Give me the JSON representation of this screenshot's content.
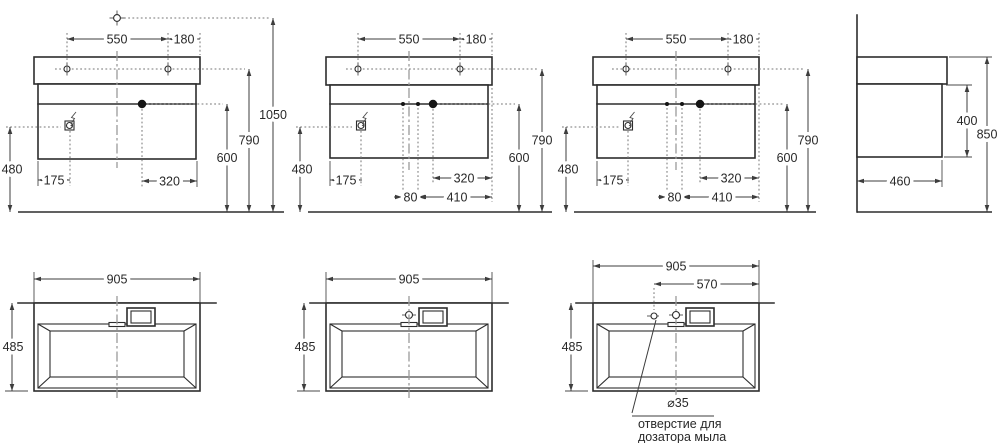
{
  "drawing": {
    "kind": "washbasin-with-cabinet-dimension-drawing",
    "front_views": [
      {
        "name": "front-overall",
        "dim_550": "550",
        "dim_180": "180",
        "dim_1050": "1050",
        "dim_790": "790",
        "dim_600": "600",
        "dim_480": "480",
        "dim_175": "175",
        "dim_320": "320"
      },
      {
        "name": "front-variant-2",
        "dim_550": "550",
        "dim_180": "180",
        "dim_790": "790",
        "dim_600": "600",
        "dim_480": "480",
        "dim_175": "175",
        "dim_320": "320",
        "dim_80": "80",
        "dim_410": "410"
      },
      {
        "name": "front-variant-3",
        "dim_550": "550",
        "dim_180": "180",
        "dim_790": "790",
        "dim_600": "600",
        "dim_480": "480",
        "dim_175": "175",
        "dim_320": "320",
        "dim_80": "80",
        "dim_410": "410"
      }
    ],
    "side_view": {
      "dim_400": "400",
      "dim_850": "850",
      "dim_460": "460"
    },
    "plan_views": [
      {
        "name": "plan-no-holes",
        "dim_905": "905",
        "dim_485": "485"
      },
      {
        "name": "plan-one-hole",
        "dim_905": "905",
        "dim_485": "485"
      },
      {
        "name": "plan-two-holes",
        "dim_905": "905",
        "dim_570": "570",
        "dim_485": "485",
        "dim_hole": "⌀35",
        "note_line1": "отверстие для",
        "note_line2": "дозатора мыла"
      }
    ]
  }
}
